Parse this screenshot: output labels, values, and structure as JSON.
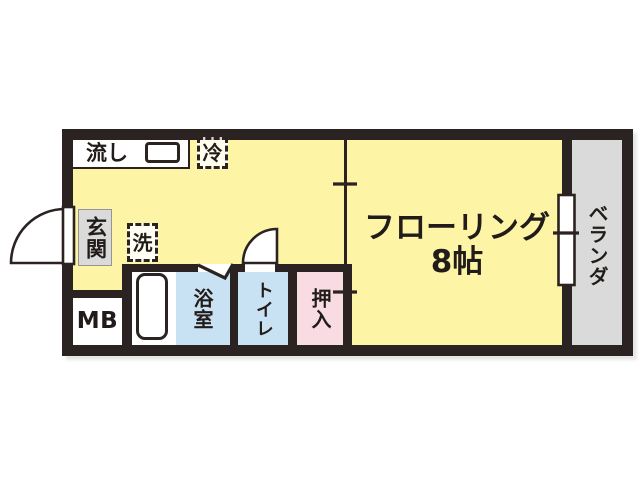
{
  "plan": {
    "type": "apartment-floor-plan",
    "kitchen": {
      "sink": "流し",
      "fridge": "冷",
      "washer": "洗"
    },
    "entrance": {
      "label": "玄関"
    },
    "meter_box": {
      "label": "MB"
    },
    "bathroom": {
      "label": "浴室"
    },
    "toilet": {
      "label": "トイレ"
    },
    "closet": {
      "label": "押入"
    },
    "main_room": {
      "name": "フローリング",
      "size": "8帖"
    },
    "veranda": {
      "label": "ベランダ"
    }
  },
  "colors": {
    "wall": "#2b2321",
    "room_yellow": "#fdf4a5",
    "wet_area_blue": "#c9e2f3",
    "closet_pink": "#f9dbe3",
    "gray_area": "#dadada"
  }
}
